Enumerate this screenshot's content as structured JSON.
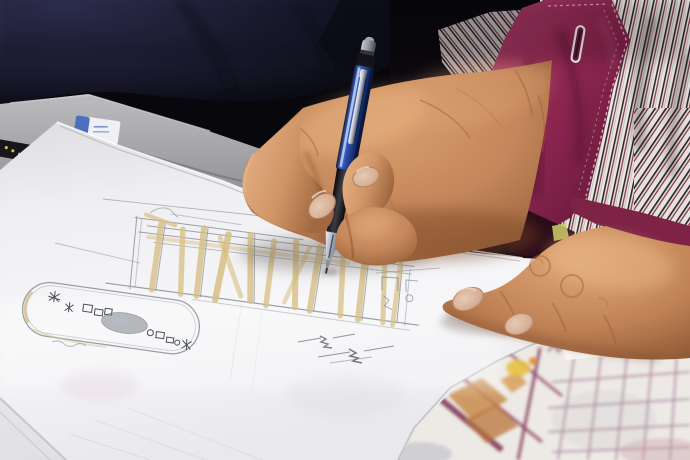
{
  "scene": {
    "type": "photograph",
    "description": "Close-up of an elderly designer's hands sketching a furniture/interior plan on white paper with a blue mechanical pencil; striped shirt with folded magenta cuff; a second blurred colored floor-plan sheet at lower right",
    "dimensions": {
      "width": 690,
      "height": 460
    },
    "objects": [
      "navy-sleeve-background",
      "gray-table-edge",
      "white-eraser",
      "white-sketch-paper",
      "elevation-sketch",
      "oval-plan-sketch",
      "pencil-scribbles",
      "blue-mechanical-pencil",
      "writing-hand",
      "resting-hand",
      "striped-shirt-sleeve",
      "magenta-cuff",
      "buttonhole",
      "colored-plan-sheet"
    ],
    "colors": {
      "background": "#050508",
      "fabric_navy": "#2b2b4a",
      "table_gray": "#a2a2a6",
      "paper": "#f2f2f4",
      "sketch_tan": "#d8c084",
      "sketch_pencil": "#868c98",
      "skin_light": "#e8b488",
      "skin_mid": "#c4865a",
      "skin_shadow": "#8a5434",
      "pen_blue": "#2b4da8",
      "pen_silver": "#c9ccd4",
      "pen_grip": "#141416",
      "cuff_magenta": "#8e2750",
      "stripe_white": "#e9e6e1",
      "stripe_maroon": "#7e2e3a",
      "stripe_black": "#2e2630",
      "eraser_blue": "#3a62b8",
      "plan_purple": "#96688a",
      "plan_maroon": "#7a3050",
      "plan_orange": "#c88a4a",
      "plan_yellow": "#e8c040"
    }
  }
}
